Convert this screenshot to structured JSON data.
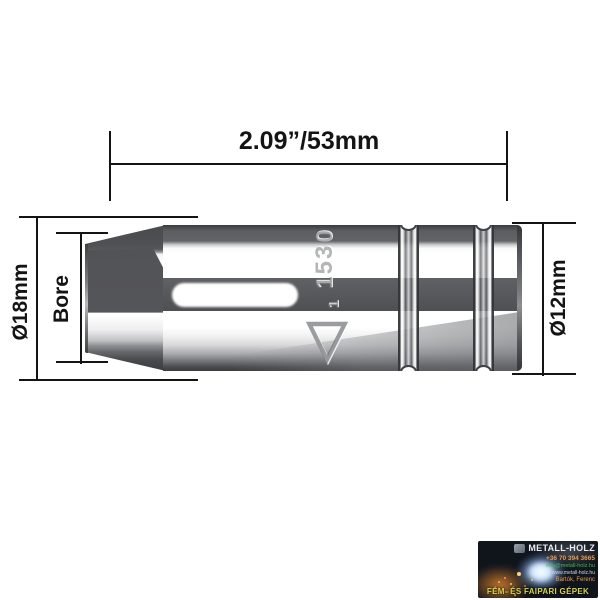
{
  "product_diagram": {
    "length_dimension": "2.09”/53mm",
    "outer_diameter": "Ø18mm",
    "bore_label": "Bore",
    "rear_diameter": "Ø12mm",
    "engraving_number": "1530",
    "engraving_mark_digit": "1",
    "engraving_triangle": "▽"
  },
  "watermark": {
    "company": "METALL-HOLZ",
    "phone": "+36 70 394 3665",
    "email": "info@metall-holz.hu",
    "website": "www.metall-holz.hu",
    "contact": "Bartók, Ferenc",
    "tagline": "FÉM- ÉS FAIPARI GÉPEK"
  },
  "colors": {
    "dimension_line": "#141414",
    "metal_dark": "#55565a",
    "metal_highlight": "#ffffff",
    "watermark_phone": "#e89a4e",
    "watermark_email": "#3dbb4d",
    "watermark_tagline": "#d6d44e"
  }
}
